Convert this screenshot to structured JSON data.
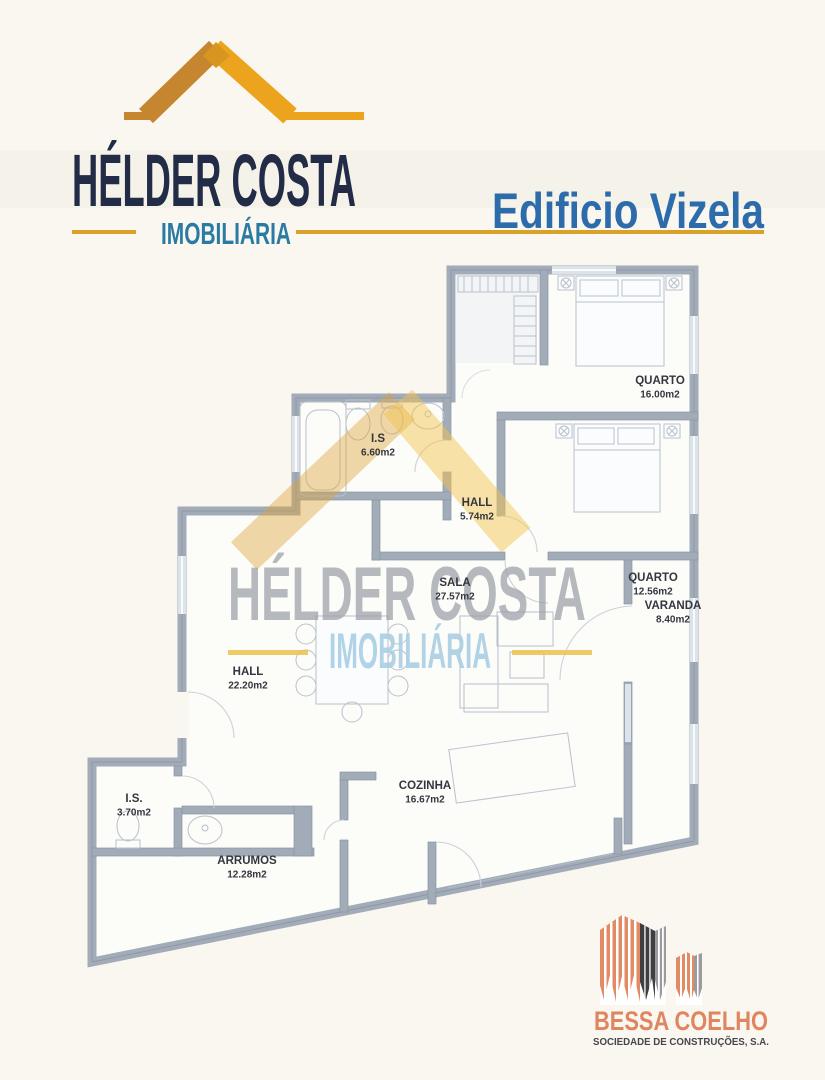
{
  "header": {
    "agency_name": "HÉLDER COSTA",
    "agency_tagline": "IMOBILIÁRIA",
    "building_title": "Edificio Vizela"
  },
  "colors": {
    "roof_dark_gold": "#c6862f",
    "roof_gold": "#eca41f",
    "agency_navy": "#222c47",
    "tagline_teal": "#2a7ba3",
    "title_blue": "#2c6cab",
    "gold_line": "#d9a22b",
    "wall_gray": "#a2abb8",
    "builder_salmon": "#df8660",
    "builder_dark": "#3f3f41"
  },
  "floorplan": {
    "rooms": [
      {
        "name": "QUARTO",
        "area": "16.00m2",
        "x": 660,
        "y": 384
      },
      {
        "name": "I.S",
        "area": "6.60m2",
        "x": 378,
        "y": 442
      },
      {
        "name": "HALL",
        "area": "5.74m2",
        "x": 477,
        "y": 506
      },
      {
        "name": "SALA",
        "area": "27.57m2",
        "x": 455,
        "y": 586
      },
      {
        "name": "QUARTO",
        "area": "12.56m2",
        "x": 653,
        "y": 581
      },
      {
        "name": "VARANDA",
        "area": "8.40m2",
        "x": 673,
        "y": 609
      },
      {
        "name": "HALL",
        "area": "22.20m2",
        "x": 248,
        "y": 675
      },
      {
        "name": "COZINHA",
        "area": "16.67m2",
        "x": 425,
        "y": 789
      },
      {
        "name": "I.S.",
        "area": "3.70m2",
        "x": 134,
        "y": 802
      },
      {
        "name": "ARRUMOS",
        "area": "12.28m2",
        "x": 247,
        "y": 864
      }
    ]
  },
  "watermark": {
    "line1": "HÉLDER COSTA",
    "line2": "IMOBILIÁRIA"
  },
  "footer": {
    "builder_name": "BESSA COELHO",
    "builder_subtitle": "SOCIEDADE DE CONSTRUÇÕES, S.A."
  }
}
